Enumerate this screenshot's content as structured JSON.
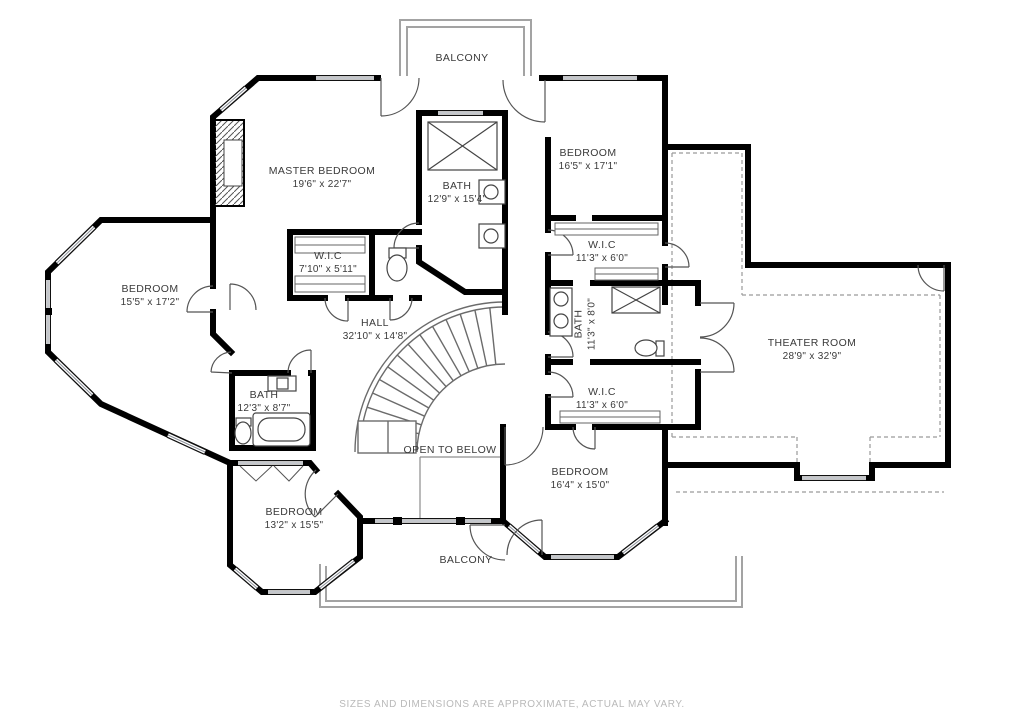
{
  "page": {
    "type": "second-floor residential floor plan",
    "background": "#ffffff",
    "footer_note": "SIZES AND DIMENSIONS ARE APPROXIMATE, ACTUAL MAY VARY."
  },
  "colors": {
    "wall": "#000000",
    "window_mid": "#8a8f98",
    "door": "#555555",
    "railing": "#a3a3a3",
    "dashed_ceiling": "#9a9a9a",
    "label_text": "#3a3a3a",
    "footer_text": "#b9b9b9"
  },
  "rooms": [
    {
      "id": "balcony-top",
      "name": "BALCONY",
      "dims": ""
    },
    {
      "id": "master-bedroom",
      "name": "MASTER BEDROOM",
      "dims": "19'6\" x 22'7\""
    },
    {
      "id": "master-bath",
      "name": "BATH",
      "dims": "12'9\" x 15'4\""
    },
    {
      "id": "bedroom-top-right",
      "name": "BEDROOM",
      "dims": "16'5\" x 17'1\""
    },
    {
      "id": "wic-upper",
      "name": "W.I.C",
      "dims": "11'3\" x 6'0\""
    },
    {
      "id": "bath-middle",
      "name": "BATH",
      "dims": "11'3\" x 8'0\""
    },
    {
      "id": "wic-lower",
      "name": "W.I.C",
      "dims": "11'3\" x 6'0\""
    },
    {
      "id": "theater-room",
      "name": "THEATER ROOM",
      "dims": "28'9\" x 32'9\""
    },
    {
      "id": "bedroom-left",
      "name": "BEDROOM",
      "dims": "15'5\" x 17'2\""
    },
    {
      "id": "wic-master",
      "name": "W.I.C",
      "dims": "7'10\" x 5'11\""
    },
    {
      "id": "hall",
      "name": "HALL",
      "dims": "32'10\" x 14'8\""
    },
    {
      "id": "bath-left",
      "name": "BATH",
      "dims": "12'3\" x 8'7\""
    },
    {
      "id": "open-to-below",
      "name": "OPEN TO BELOW",
      "dims": ""
    },
    {
      "id": "bedroom-bottom-left",
      "name": "BEDROOM",
      "dims": "13'2\" x 15'5\""
    },
    {
      "id": "bedroom-bottom-right",
      "name": "BEDROOM",
      "dims": "16'4\" x 15'0\""
    },
    {
      "id": "balcony-bottom",
      "name": "BALCONY",
      "dims": ""
    }
  ]
}
